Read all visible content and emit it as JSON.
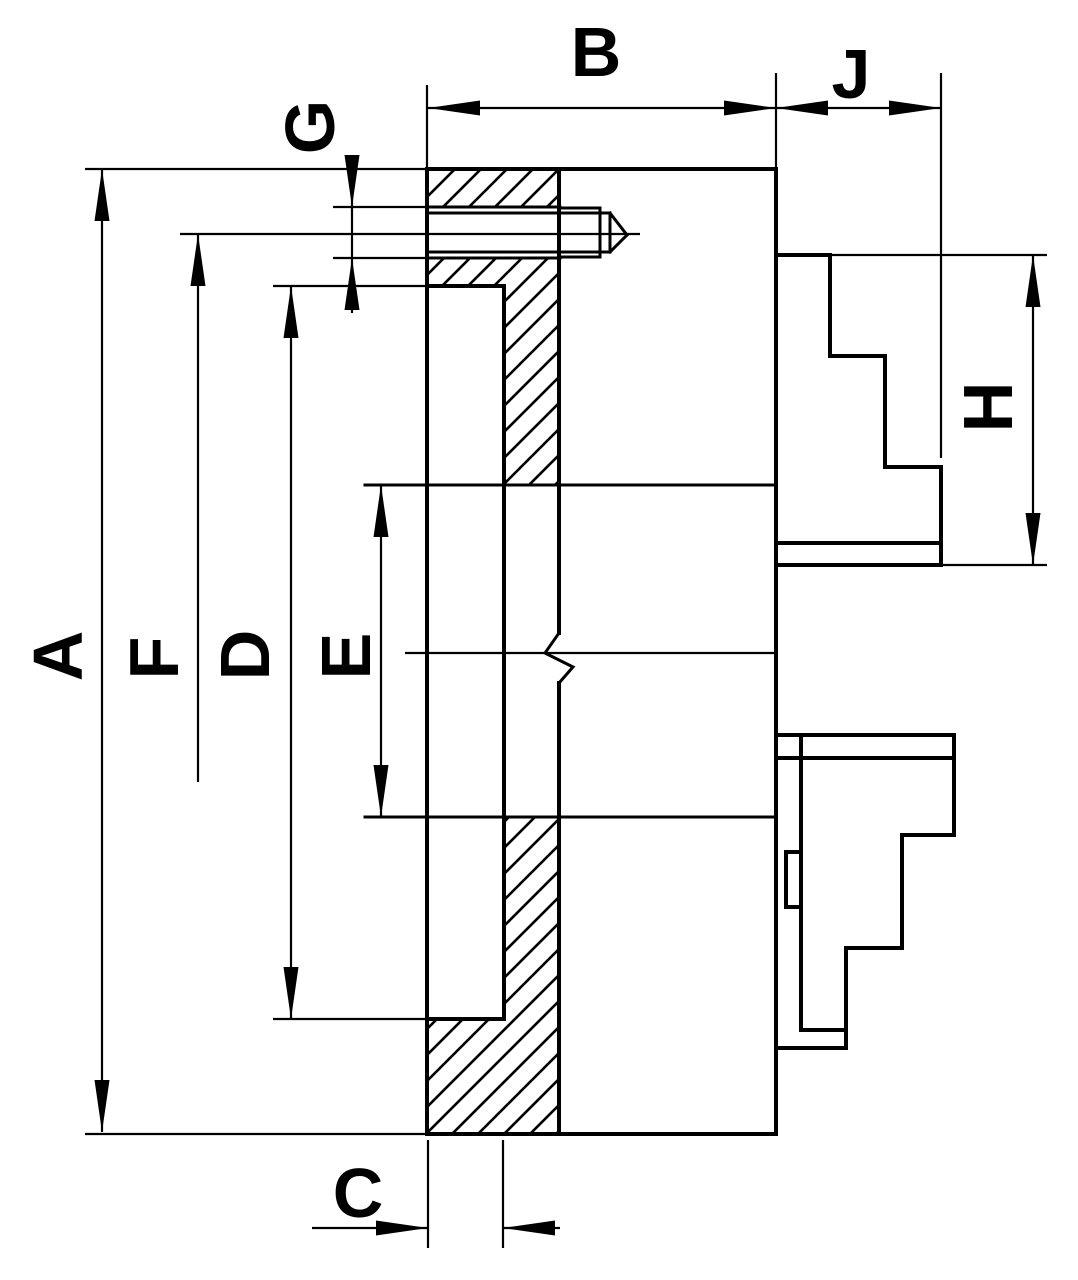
{
  "drawing": {
    "type": "technical-section-drawing",
    "subject": "chuck-cross-section",
    "colors": {
      "line": "#000000",
      "background": "#ffffff"
    },
    "labels": {
      "A": "A",
      "B": "B",
      "C": "C",
      "D": "D",
      "E": "E",
      "F": "F",
      "G": "G",
      "H": "H",
      "J": "J"
    }
  }
}
